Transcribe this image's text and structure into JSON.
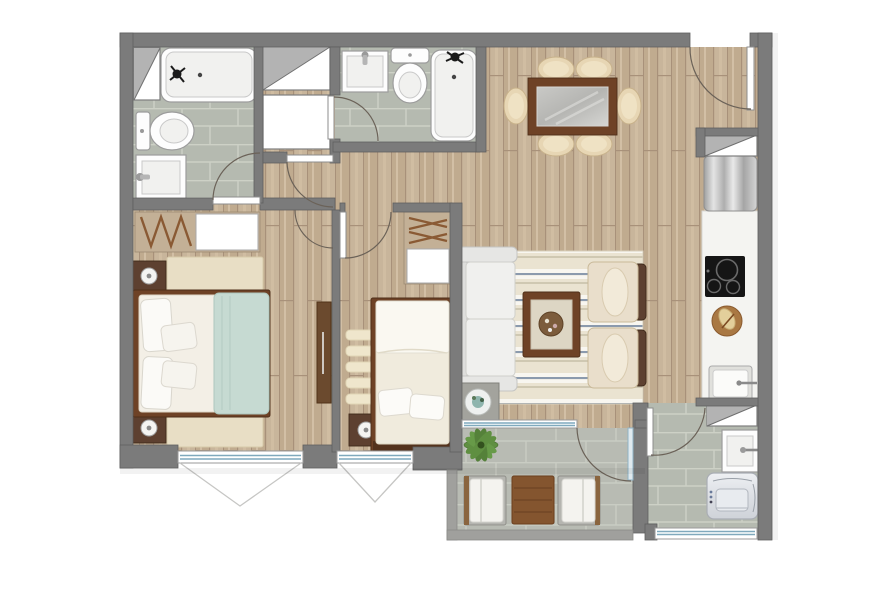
{
  "title": "apartment-floor-plan",
  "palette": {
    "wall": "#7b7b7b",
    "rail": "#a0a09d",
    "wood_floor": "#c8b59b",
    "bath_tile": "#b5bab0",
    "outdoor_tile": "#b8bbb3",
    "fixture_white": "#fdfdfd",
    "wood_furniture": "#6e4226",
    "cream_upholstery": "#e7d6b4",
    "blanket_teal": "#c6dad2",
    "window_glazing": "#7fa9bd",
    "plant_green": "#5f8f41",
    "door_arc": "#6b6258"
  },
  "rooms": [
    {
      "name": "bathroom-1",
      "floor": "tile",
      "contents": [
        "bathtub",
        "toilet",
        "sink",
        "vent-shaft"
      ]
    },
    {
      "name": "bathroom-2",
      "floor": "tile",
      "contents": [
        "sink",
        "toilet",
        "bathtub"
      ]
    },
    {
      "name": "hallway",
      "floor": "wood",
      "contents": [
        "vent-shaft-hatched",
        "vent-shaft-plain"
      ]
    },
    {
      "name": "dining-area",
      "floor": "wood",
      "contents": [
        "dining-table",
        "dining-chairs x6"
      ]
    },
    {
      "name": "kitchen",
      "floor": "wood",
      "contents": [
        "refrigerator",
        "counter",
        "cooktop",
        "cutting-board",
        "kitchen-sink",
        "vent-shafts x2"
      ]
    },
    {
      "name": "living-room",
      "floor": "wood",
      "contents": [
        "sofa",
        "striped-rug",
        "coffee-table",
        "armchairs x2",
        "side-table-with-planter"
      ]
    },
    {
      "name": "bedroom-1",
      "floor": "wood",
      "contents": [
        "closet-with-hangers",
        "double-bed",
        "nightstands x2",
        "rug",
        "sliding-door-panel"
      ]
    },
    {
      "name": "bedroom-2",
      "floor": "wood",
      "contents": [
        "closet-with-hangers",
        "single-bed",
        "nightstand",
        "striped-rug"
      ]
    },
    {
      "name": "terrace",
      "floor": "tile",
      "contents": [
        "plant",
        "lounge-chairs x2",
        "outdoor-table",
        "railing"
      ]
    },
    {
      "name": "laundry",
      "floor": "tile",
      "contents": [
        "laundry-sink",
        "washing-machine"
      ]
    }
  ],
  "openings": {
    "doors": [
      "entry-door",
      "bathroom-1-door",
      "hallway-door",
      "bathroom-2-door",
      "bedroom-1-door",
      "bedroom-2-door",
      "terrace-door",
      "laundry-door"
    ],
    "windows": [
      "bedroom-1-window",
      "bedroom-2-window",
      "living-terrace-window",
      "laundry-window"
    ]
  }
}
